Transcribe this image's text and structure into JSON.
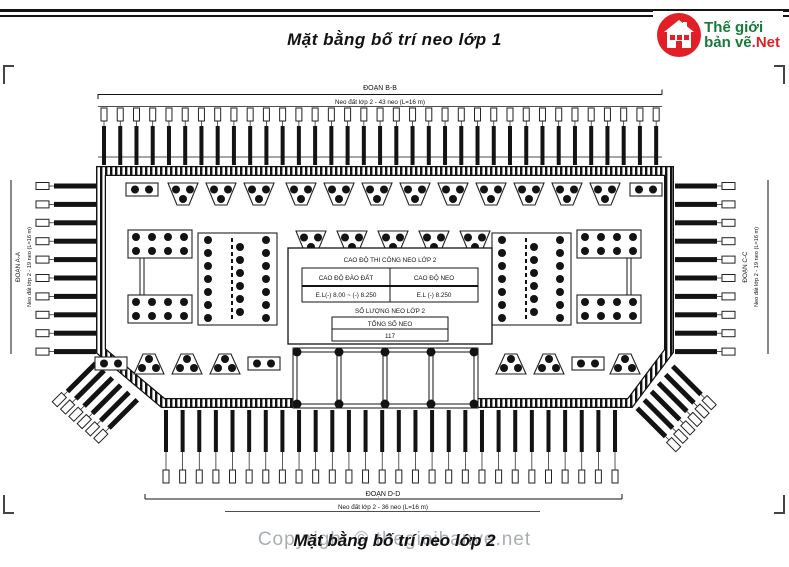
{
  "page": {
    "title_top": "Mặt bằng bố trí neo lớp 1",
    "title_bottom": "Mặt bằng bố trí neo lớp 2",
    "watermark": "Copyright © thegioibanve.net"
  },
  "logo": {
    "line1": "Thế giới",
    "line2": "bản vẽ",
    "suffix": ".Net",
    "icon": "house-icon",
    "green": "#17793a",
    "red": "#e01f26"
  },
  "drawing": {
    "sections": {
      "top": {
        "name": "ĐOẠN B-B",
        "note": "Neo đất lớp 2 - 43 neo (L=16 m)"
      },
      "bottom": {
        "name": "ĐOẠN D-D",
        "note": "Neo đất lớp 2 - 36 neo (L=16 m)"
      },
      "left": {
        "name": "ĐOẠN A-A",
        "note": "Neo đất lớp 2 - 19 neo (L=16 m)"
      },
      "right": {
        "name": "ĐOẠN C-C",
        "note": "Neo đất lớp 2 - 19 neo (L=16 m)"
      }
    },
    "info_table": {
      "title": "CAO ĐỘ THI CÔNG NEO LỚP 2",
      "col1_header": "CAO ĐỘ ĐÀO ĐẤT",
      "col2_header": "CAO ĐỘ NEO",
      "col1_value": "E.L(-) 8.00 ~ (-) 8.250",
      "col2_value": "E.L (-) 8.250",
      "qty_title": "SỐ LƯỢNG NEO LỚP 2",
      "total_label": "TỔNG SỐ NEO",
      "total_value": "117"
    }
  }
}
